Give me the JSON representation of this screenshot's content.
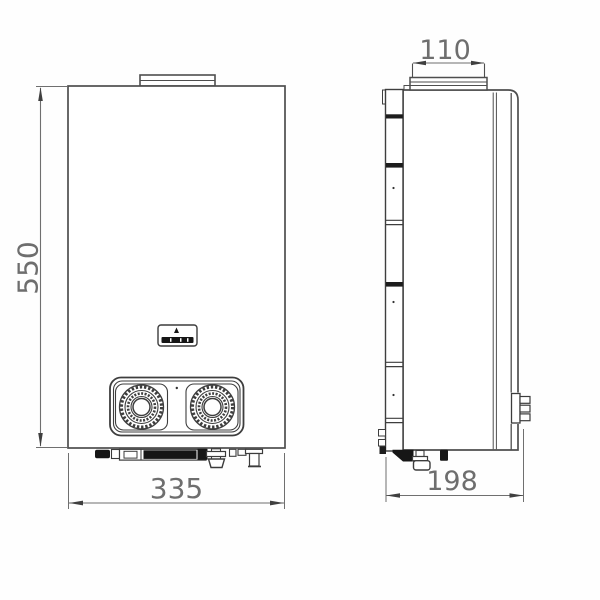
{
  "diagram": {
    "type": "technical-dimension-drawing",
    "subject": "wall-mounted tankless gas water heater, front and side orthographic views",
    "dimensions": {
      "front_height": "550",
      "front_width": "335",
      "flue_width": "110",
      "side_depth": "198"
    },
    "colors": {
      "line": "#4e4e4e",
      "dimension_line": "#6f6f6f",
      "label_text": "#6e6e6e",
      "dark_fill": "#161616",
      "background": "#fefefe"
    },
    "components": {
      "front_view": [
        "flue-collar",
        "display-window",
        "control-panel",
        "left-knob",
        "right-knob",
        "bottom-pipe-connections"
      ],
      "side_view": [
        "wall-mount-rail",
        "flue-collar",
        "panel-seams",
        "connector-block",
        "bottom-fittings"
      ]
    }
  }
}
